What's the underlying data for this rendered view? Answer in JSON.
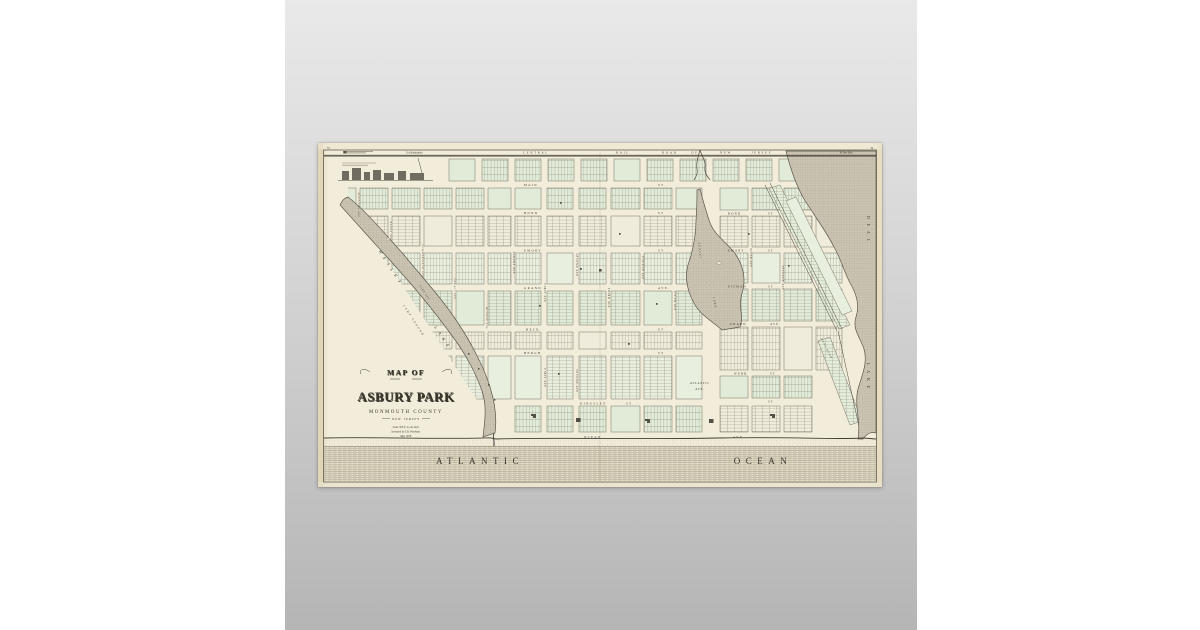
{
  "page": {
    "background_color": "#ffffff"
  },
  "poster": {
    "background_top": "#e9e9e9",
    "background_bottom": "#b5b5b5"
  },
  "map_sheet": {
    "paper_color": "#f2edda",
    "ink_color": "#3a362c",
    "block_green": "#e1ebd8",
    "water_gray": "#cbc4b2",
    "corner_left": "33",
    "corner_right": "34",
    "railroad": {
      "to_left": "To Philadelphia",
      "words": [
        "CENTRAL",
        "RAIL",
        "ROAD",
        "OF",
        "NEW",
        "JERSEY"
      ],
      "to_right": "To New York"
    },
    "streets": {
      "main": {
        "name": "MAIN",
        "suffix": "ST"
      },
      "bond": {
        "name": "BOND",
        "suffix": "ST"
      },
      "emory": {
        "name": "EMORY",
        "suffix": "ST"
      },
      "grand": {
        "name": "GRAND",
        "suffix": "AVE."
      },
      "heck": {
        "name": "HECK",
        "suffix": "ST"
      },
      "bergh": {
        "name": "BERGH",
        "suffix": "ST"
      },
      "kingsley": {
        "name": "KINGSLEY",
        "suffix": "ST"
      },
      "ocean": {
        "name": "OCEAN",
        "suffix": "AVE."
      }
    },
    "streets_north": {
      "bond": {
        "name": "BOND",
        "suffix": "ST"
      },
      "emory": {
        "name": "EMORY",
        "suffix": "ST"
      },
      "pitman": {
        "name": "PITMAN",
        "suffix": "ST"
      },
      "grand": {
        "name": "GRAND",
        "suffix": "AVE."
      },
      "webb": {
        "name": "WEBB",
        "suffix": "ST"
      },
      "st_only": "ST"
    },
    "avenues_central": [
      "ASBURY AVE",
      "FIRST AVE",
      "SECOND AVE",
      "THIRD AVE",
      "FOURTH AVE",
      "FIFTH AVE"
    ],
    "avenues_north": [
      "SIXTH AVE",
      "SEVENTH AVE"
    ],
    "avenues_west": [
      "MATTISON AVE",
      "BANGS AVE",
      "SUMMERFIELD AVE",
      "SEWALL AVE",
      "MUNROE AVE"
    ],
    "water": {
      "wesley_word1": "WESLEY",
      "wesley_word2": "LAKE",
      "camp_ground": "CAMP GROUND",
      "lake_ave": "LAKE AVE",
      "sunset_word1": "SUNSET",
      "sunset_word2": "LAKE",
      "deal_word1": "DEAL",
      "deal_word2": "LAKE",
      "deal_road": "DEAL ROAD",
      "atlantic_ave_line1": "ATLANTIC",
      "atlantic_ave_line2": "AVE."
    },
    "ocean": {
      "word1": "ATLANTIC",
      "word2": "OCEAN"
    },
    "title": {
      "line1": "MAP OF",
      "line2": "ASBURY PARK",
      "line3": "MONMOUTH COUNTY",
      "line4": "NEW JERSEY",
      "notes": [
        "Scale 300 ft. to one inch.",
        "Surveyed by T.B. Woolman.",
        "May 1878."
      ]
    }
  }
}
